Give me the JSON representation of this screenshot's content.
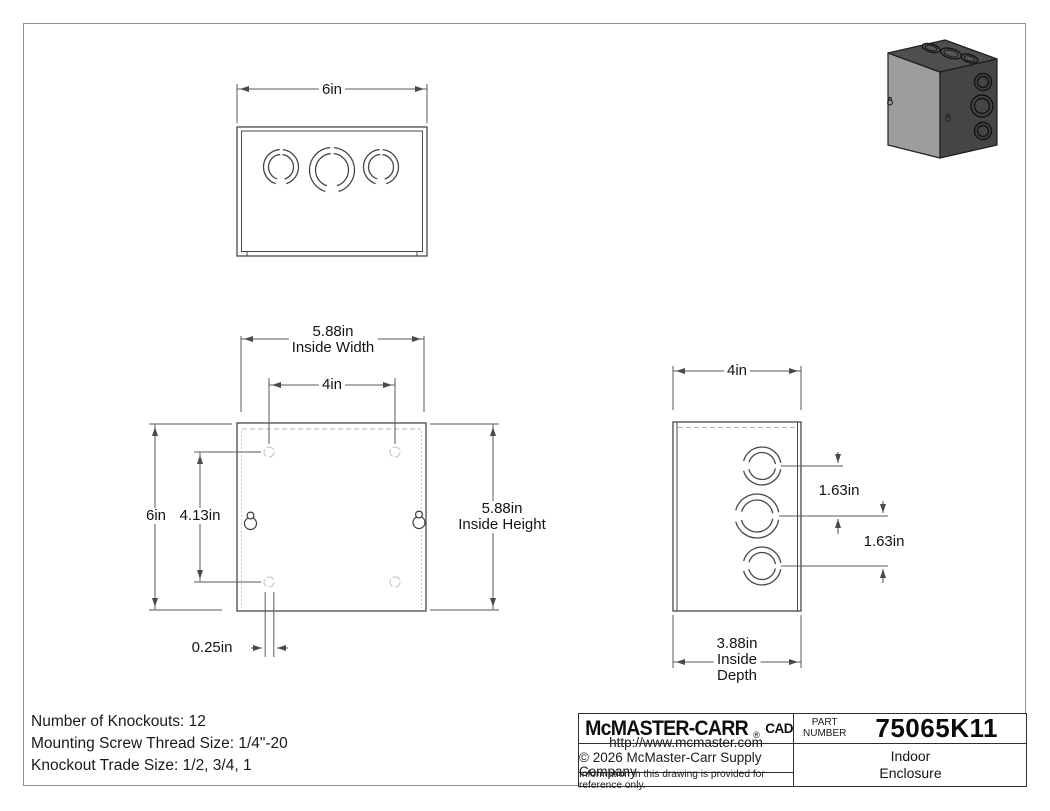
{
  "views": {
    "top": {
      "width": "6in"
    },
    "front": {
      "inside_width": "5.88in",
      "inside_width_caption": "Inside Width",
      "mount_hole_spacing_h": "4in",
      "outside_height": "6in",
      "mount_hole_spacing_v": "4.13in",
      "inside_height": "5.88in",
      "inside_height_caption": "Inside Height",
      "hole_edge_offset": "0.25in"
    },
    "side": {
      "outside_depth": "4in",
      "knockout_spacing_top": "1.63in",
      "knockout_spacing_bottom": "1.63in",
      "inside_depth": "3.88in",
      "inside_depth_caption1": "Inside",
      "inside_depth_caption2": "Depth"
    }
  },
  "specs": {
    "line1": "Number of Knockouts: 12",
    "line2": "Mounting Screw Thread Size: 1/4\"-20",
    "line3": "Knockout Trade Size: 1/2, 3/4, 1"
  },
  "title_block": {
    "brand": "McMASTER-CARR",
    "registered_mark": "®",
    "cad_label": "CAD",
    "part_label_line1": "PART",
    "part_label_line2": "NUMBER",
    "part_number": "75065K11",
    "website": "http://www.mcmaster.com",
    "copyright": "© 2026 McMaster-Carr Supply Company",
    "disclaimer": "Information in this drawing is provided for reference only.",
    "product_name_line1": "Indoor",
    "product_name_line2": "Enclosure"
  },
  "colors": {
    "box_front": "#9d9d9d",
    "box_top": "#4f4f4f",
    "box_side": "#454545"
  }
}
